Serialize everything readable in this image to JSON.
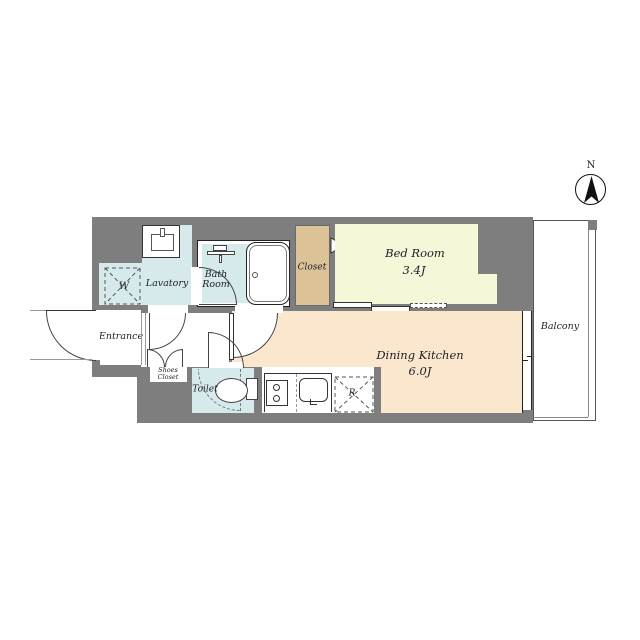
{
  "title": "apartment-floor-plan",
  "compass": {
    "north_label": "N"
  },
  "rooms": {
    "bedroom": {
      "name": "Bed Room",
      "size": "3.4J",
      "color": "#f6f6d9"
    },
    "dining_kitchen": {
      "name": "Dining Kitchen",
      "size": "6.0J",
      "color": "#fbe7cd"
    },
    "lavatory": {
      "name": "Lavatory",
      "color": "#d6eaec"
    },
    "bath_room": {
      "line1": "Bath",
      "line2": "Room",
      "color": "#d6eaec"
    },
    "closet": {
      "name": "Closet",
      "color": "#dbc297"
    },
    "entrance": {
      "name": "Entrance",
      "color": "#ffffff"
    },
    "shoes_closet": {
      "line1": "Shoes",
      "line2": "Closet",
      "color": "#ffffff"
    },
    "toilet": {
      "name": "Toilet",
      "color": "#d6eaec"
    },
    "balcony": {
      "name": "Balcony",
      "color": "#ffffff"
    }
  },
  "markers": {
    "washing_machine": "W",
    "refrigerator": "R"
  },
  "colors": {
    "wall": "#7e7e7e",
    "outline": "#333333",
    "water_rooms": "#d6eaec",
    "bedroom": "#f6f6d9",
    "dining_kitchen": "#fbe7cd",
    "closet": "#dbc297"
  }
}
